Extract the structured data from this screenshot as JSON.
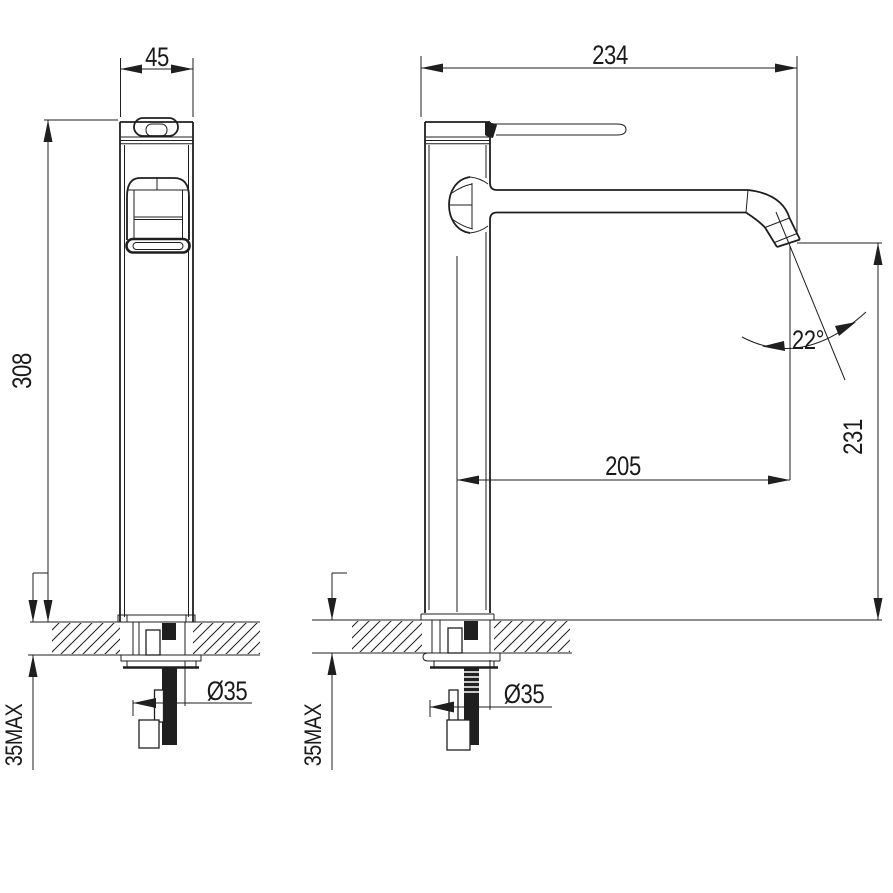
{
  "drawing": {
    "front_view": {
      "width_mm": "45",
      "height_mm": "308",
      "hole_diameter": "Ø35",
      "max_counter_thickness": "35MAX"
    },
    "side_view": {
      "depth_mm": "234",
      "spout_reach_mm": "205",
      "spout_height_mm": "231",
      "spout_angle": "22°",
      "hole_diameter": "Ø35",
      "max_counter_thickness": "35MAX"
    }
  }
}
